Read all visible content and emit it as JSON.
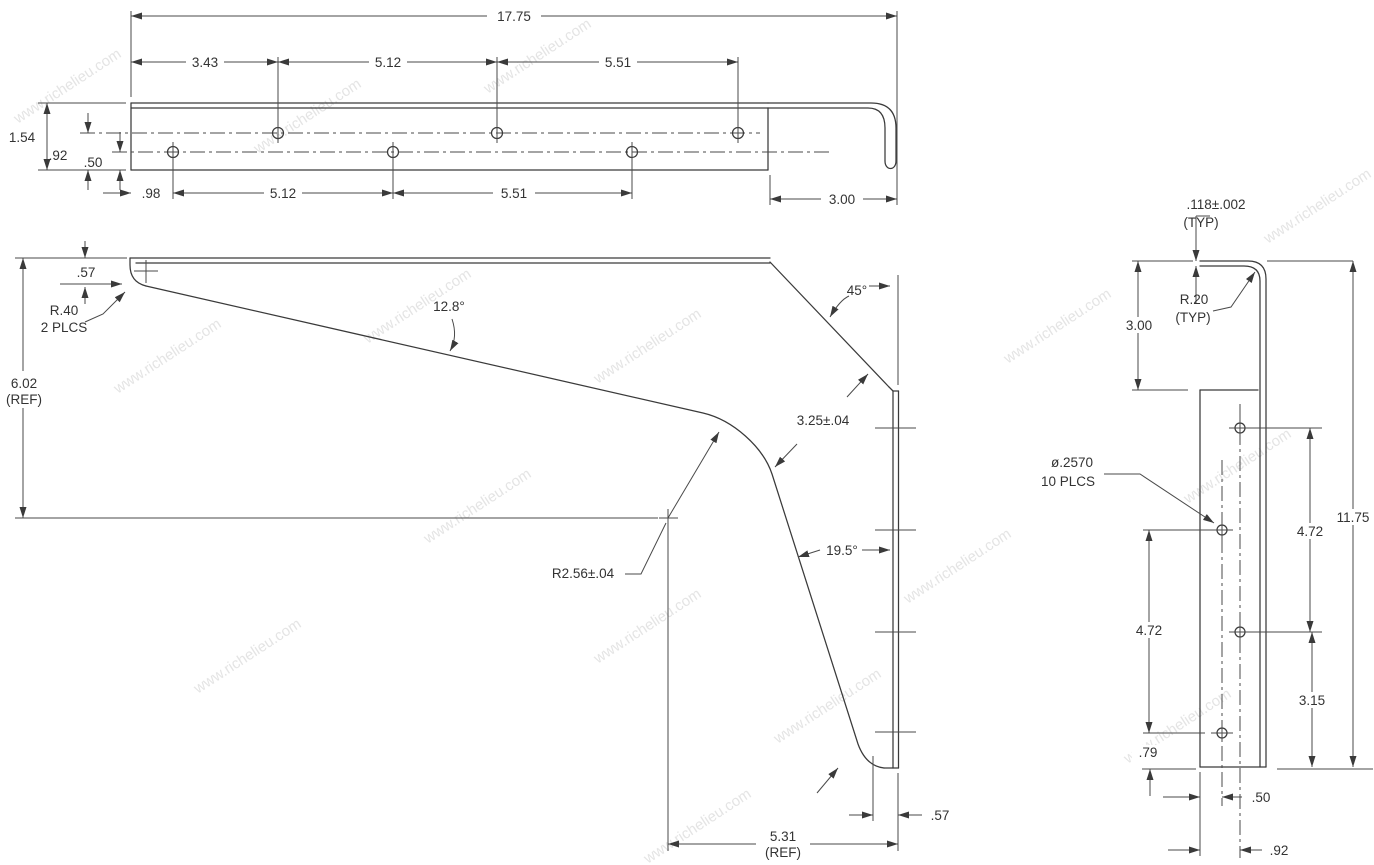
{
  "watermark": "www.richelieu.com",
  "views": {
    "top": {
      "title": "top view of bracket arm"
    },
    "front": {
      "title": "front profile of bracket"
    },
    "side": {
      "title": "side view of wall plate"
    }
  },
  "dims": {
    "top": {
      "overall": "17.75",
      "span1": "3.43",
      "span2": "5.12",
      "span3": "5.51",
      "height": "1.54",
      "row_upper": ".92",
      "row_lower": ".50",
      "offset": ".98",
      "lower_span1": "5.12",
      "lower_span2": "5.51",
      "flange_width": "3.00"
    },
    "front": {
      "tip_drop": ".57",
      "tip_radius": "R.40",
      "tip_radius_qty": "2 PLCS",
      "taper_angle": "12.8°",
      "chamfer_angle": "45°",
      "height": "6.02",
      "height_ref": "(REF)",
      "neck": "3.25±.04",
      "throat_radius": "R2.56±.04",
      "leg_angle": "19.5°",
      "leg_span": "5.31",
      "leg_span_ref": "(REF)",
      "leg_width": ".57"
    },
    "side": {
      "thickness": ".118±.002",
      "thickness_typ": "(TYP)",
      "bend_radius": "R.20",
      "bend_radius_typ": "(TYP)",
      "drop": "3.00",
      "hole_dia": "ø.2570",
      "hole_qty": "10 PLCS",
      "pitch_right": "4.72",
      "plate_height": "11.75",
      "pitch_left": "4.72",
      "bottom_pitch": "3.15",
      "edge_offset": ".79",
      "col_offset_left": ".50",
      "col_offset_right": ".92"
    }
  }
}
